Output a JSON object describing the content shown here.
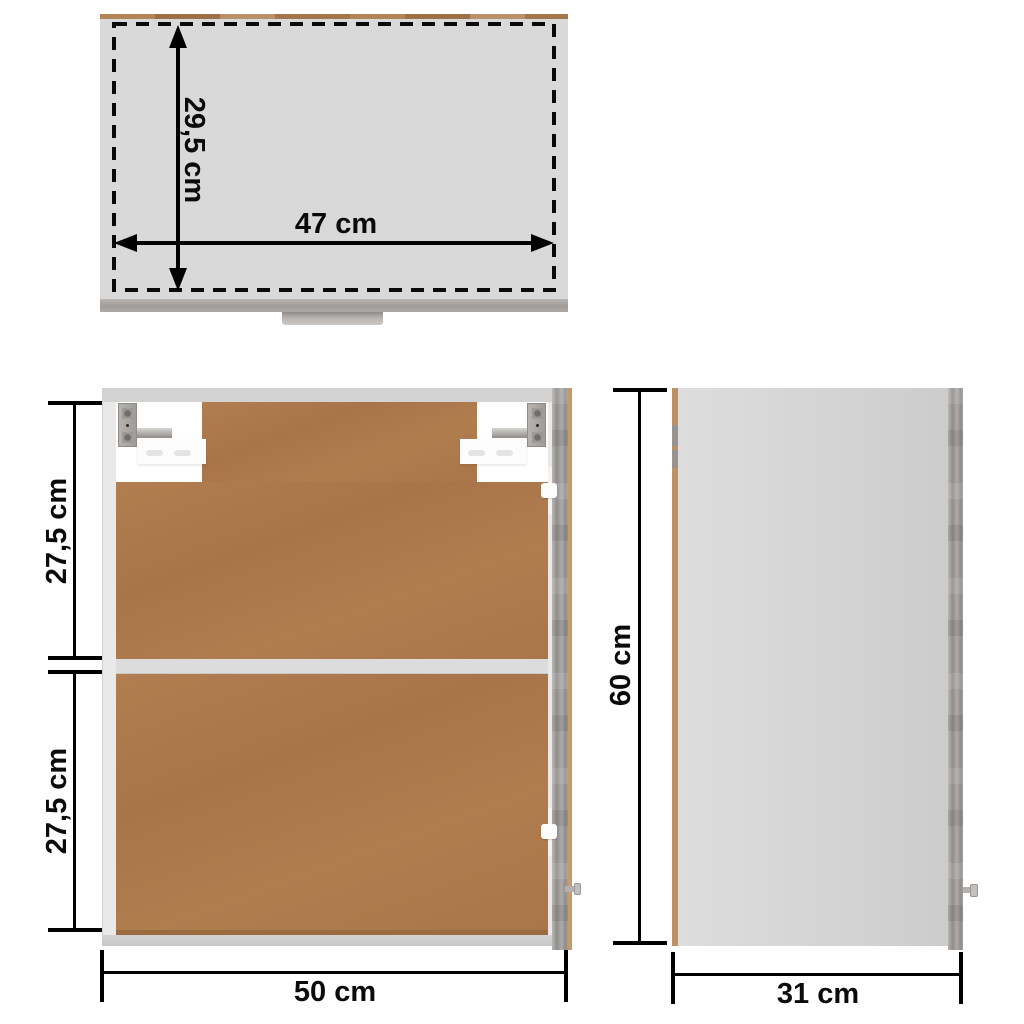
{
  "diagram": {
    "type": "furniture-dimension-diagram",
    "subject": "wall-hung cabinet with open door, three orthographic views"
  },
  "views": {
    "top": {
      "name": "top view",
      "depth": "29,5 cm",
      "width": "47 cm"
    },
    "front": {
      "name": "front view",
      "upper": "27,5 cm",
      "lower": "27,5 cm",
      "width": "50 cm"
    },
    "side": {
      "name": "side view",
      "height": "60 cm",
      "depth": "31 cm"
    }
  },
  "colors": {
    "background": "#ffffff",
    "dimension_lines": "#000000",
    "cabinet_gray": "#d9d9d9",
    "concrete_gray_door": "#a09d9a",
    "back_panel_brown": "#ad7a4c",
    "wood_edge_tan": "#b3895e",
    "frame_white": "#e9e9e9"
  }
}
